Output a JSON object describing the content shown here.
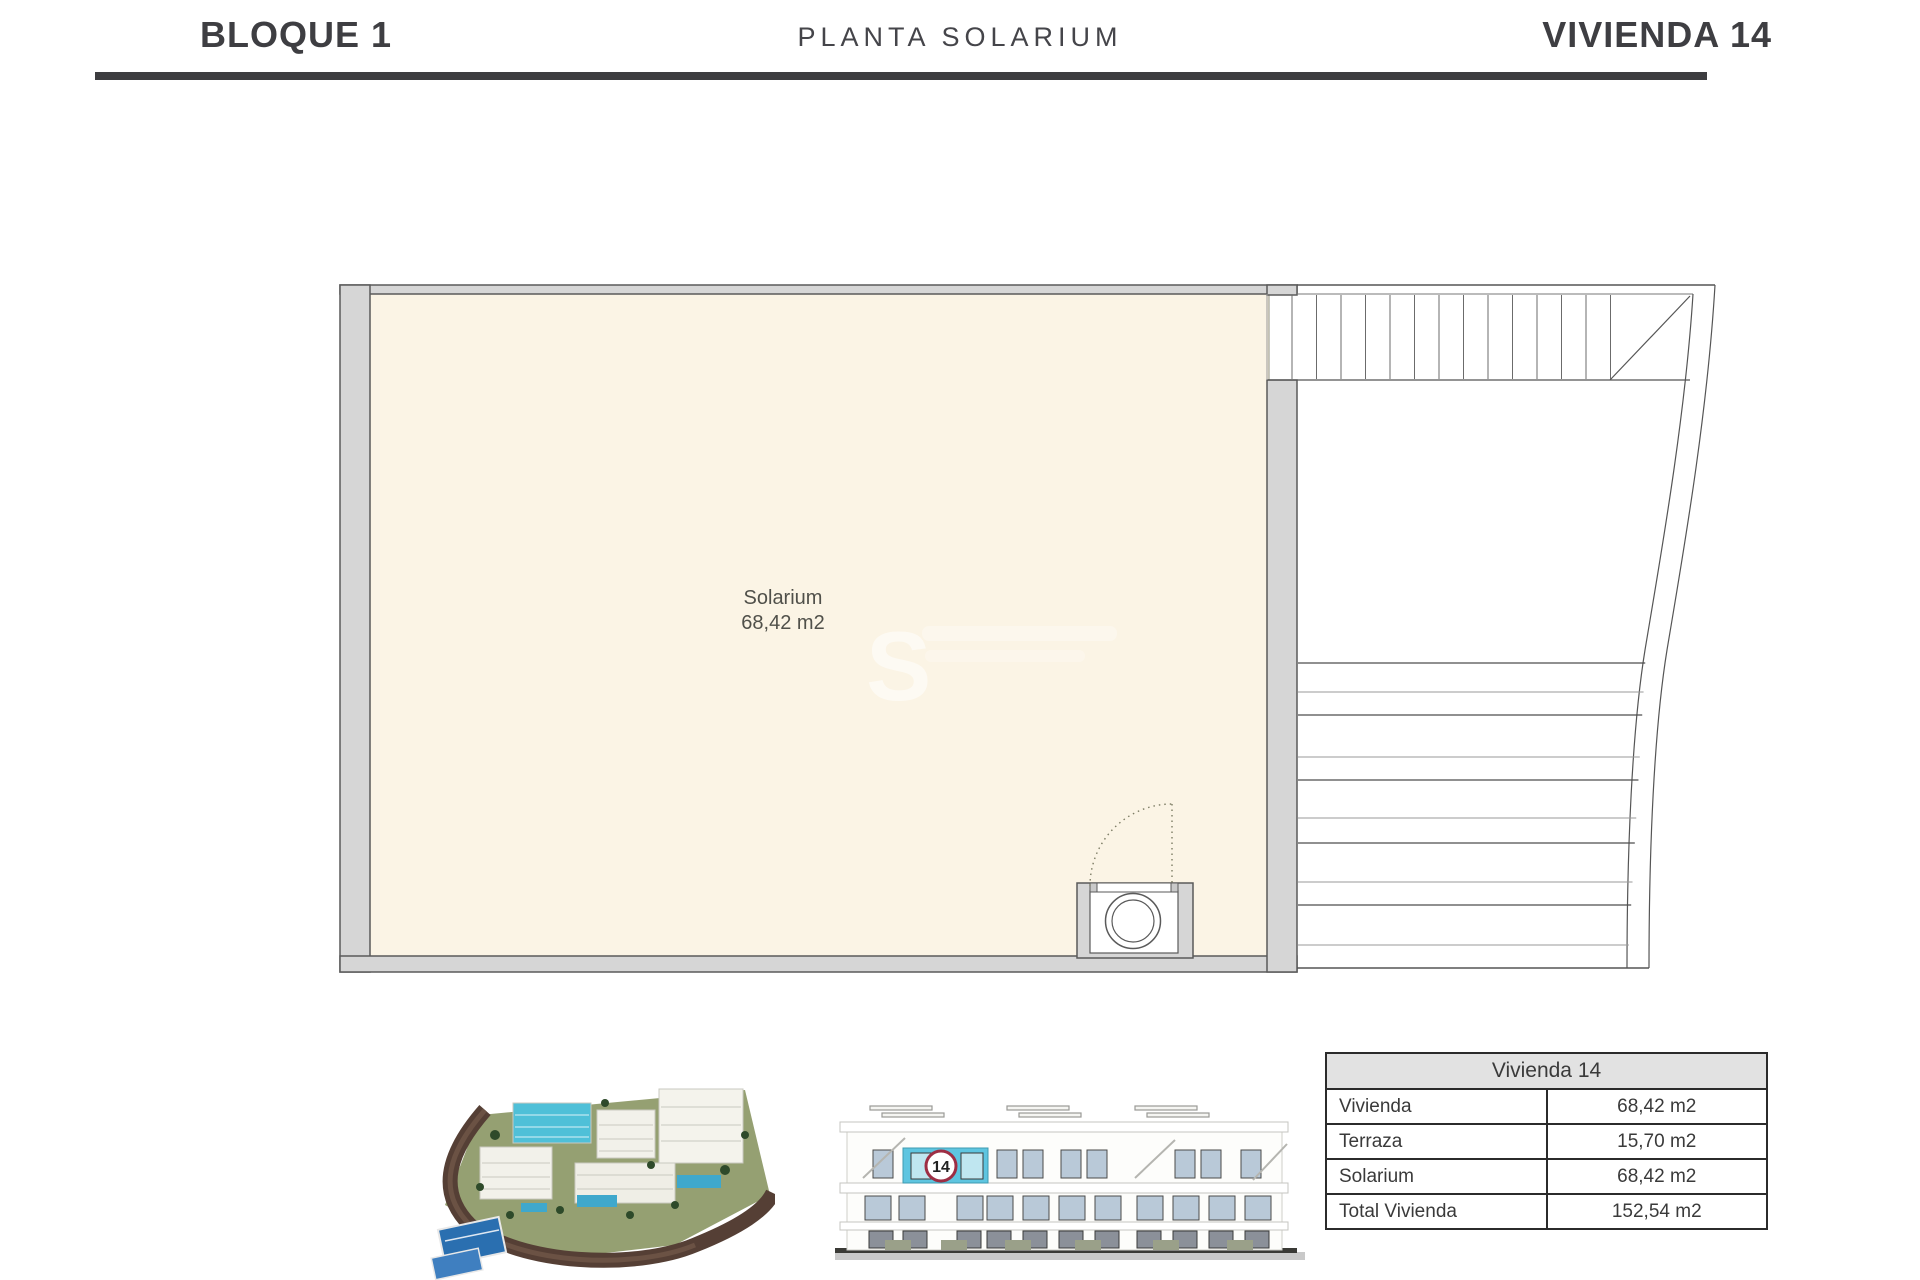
{
  "header": {
    "left": "BLOQUE 1",
    "center": "PLANTA SOLARIUM",
    "right": "VIVIENDA 14"
  },
  "plan": {
    "room_label": "Solarium",
    "room_area": "68,42 m2",
    "watermark": "S"
  },
  "elevation": {
    "unit_number": "14"
  },
  "summary_table": {
    "title": "Vivienda 14",
    "rows": [
      {
        "label": "Vivienda",
        "value": "68,42 m2"
      },
      {
        "label": "Terraza",
        "value": "15,70 m2"
      },
      {
        "label": "Solarium",
        "value": "68,42 m2"
      },
      {
        "label": "Total Vivienda",
        "value": "152,54 m2"
      }
    ]
  },
  "colors": {
    "floor_cream": "#FBF4E5",
    "wall_gray": "#D6D6D6",
    "accent_cyan": "#5EC5E0",
    "badge_ring": "#9D2E44",
    "header_bar": "#3D3D40"
  }
}
